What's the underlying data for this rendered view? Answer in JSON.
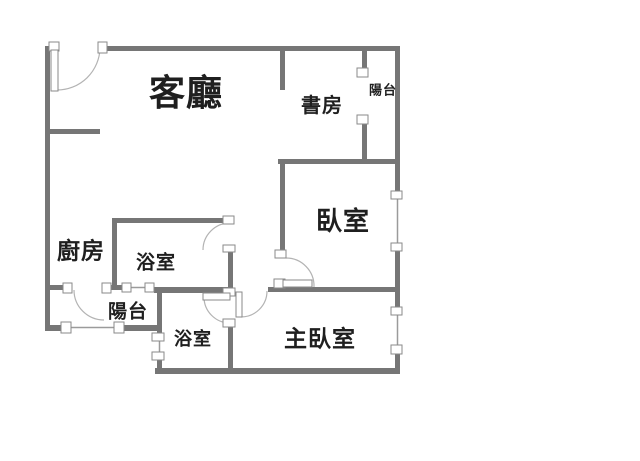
{
  "canvas": {
    "width": 640,
    "height": 461,
    "background": "#ffffff"
  },
  "colors": {
    "wall": "#767676",
    "window_line": "#9b9b9b",
    "door_arc": "#b3b3b3",
    "jamb_fill": "#ffffff",
    "jamb_border": "#8a8a8a",
    "label_text": "#1f1f1f"
  },
  "rooms": [
    {
      "id": "living-room",
      "label": "客廳",
      "cx": 186,
      "cy": 94,
      "font_size": 36
    },
    {
      "id": "study",
      "label": "書房",
      "cx": 322,
      "cy": 105,
      "font_size": 20
    },
    {
      "id": "balcony-top",
      "label": "陽台",
      "cx": 383,
      "cy": 91,
      "font_size": 13
    },
    {
      "id": "bedroom",
      "label": "臥室",
      "cx": 343,
      "cy": 222,
      "font_size": 26
    },
    {
      "id": "kitchen",
      "label": "廚房",
      "cx": 81,
      "cy": 252,
      "font_size": 23
    },
    {
      "id": "bathroom-top",
      "label": "浴室",
      "cx": 156,
      "cy": 263,
      "font_size": 19
    },
    {
      "id": "balcony-bottom",
      "label": "陽台",
      "cx": 128,
      "cy": 312,
      "font_size": 19
    },
    {
      "id": "bathroom-bottom",
      "label": "浴室",
      "cx": 193,
      "cy": 340,
      "font_size": 18
    },
    {
      "id": "master-bedroom",
      "label": "主臥室",
      "cx": 320,
      "cy": 340,
      "font_size": 23
    }
  ],
  "walls": [
    {
      "name": "top-wall",
      "rect": [
        103,
        46,
        297,
        5
      ]
    },
    {
      "name": "kitchen-stub-wall",
      "rect": [
        45,
        129,
        55,
        5
      ]
    },
    {
      "name": "study-bottom-wall",
      "rect": [
        278,
        159,
        122,
        5
      ]
    },
    {
      "name": "bath1-top-wall",
      "rect": [
        112,
        218,
        112,
        5
      ]
    },
    {
      "name": "kitchen-bottom-wall",
      "rect": [
        45,
        285,
        20,
        5
      ]
    },
    {
      "name": "mid-bottom-wall",
      "rect": [
        111,
        285,
        13,
        5
      ]
    },
    {
      "name": "bath2-top-wall",
      "rect": [
        154,
        287,
        79,
        6
      ]
    },
    {
      "name": "master-top-wall",
      "rect": [
        268,
        287,
        132,
        5
      ]
    },
    {
      "name": "balcony-bottom-left-wall",
      "rect": [
        45,
        325,
        19,
        6
      ]
    },
    {
      "name": "balcony-bottom-right-wall",
      "rect": [
        123,
        325,
        38,
        6
      ]
    },
    {
      "name": "bottom-wall",
      "rect": [
        155,
        368,
        245,
        6
      ]
    },
    {
      "name": "left-wall",
      "rect": [
        45,
        46,
        5,
        285
      ]
    },
    {
      "name": "living-study-divider",
      "rect": [
        280,
        46,
        5,
        44
      ]
    },
    {
      "name": "bedroom-left-wall",
      "rect": [
        280,
        162,
        5,
        90
      ]
    },
    {
      "name": "study-balcony-divider-upper",
      "rect": [
        362,
        46,
        5,
        25
      ]
    },
    {
      "name": "study-balcony-divider-lower",
      "rect": [
        362,
        122,
        5,
        42
      ]
    },
    {
      "name": "kitchen-bath-divider",
      "rect": [
        112,
        218,
        5,
        72
      ]
    },
    {
      "name": "hall-bath1-wall",
      "rect": [
        228,
        250,
        5,
        46
      ]
    },
    {
      "name": "bath2-left-wall-upper",
      "rect": [
        157,
        290,
        5,
        46
      ]
    },
    {
      "name": "bath2-left-wall-lower",
      "rect": [
        157,
        359,
        5,
        15
      ]
    },
    {
      "name": "bath2-master-divider",
      "rect": [
        228,
        325,
        5,
        49
      ]
    },
    {
      "name": "right-wall-top",
      "rect": [
        395,
        46,
        5,
        147
      ]
    },
    {
      "name": "right-wall-mid",
      "rect": [
        395,
        250,
        5,
        60
      ]
    },
    {
      "name": "right-wall-bottom",
      "rect": [
        395,
        352,
        5,
        22
      ]
    }
  ],
  "windows": [
    {
      "name": "balcony-bottom-window",
      "line": [
        71,
        327.5,
        116,
        327.5
      ]
    },
    {
      "name": "bath1-balcony-window",
      "line": [
        131,
        287.5,
        147,
        287.5
      ]
    },
    {
      "name": "bath2-left-window",
      "line": [
        159.5,
        341,
        159.5,
        353
      ]
    },
    {
      "name": "bedroom-right-window",
      "line": [
        397.5,
        199,
        397.5,
        244
      ]
    },
    {
      "name": "master-right-window",
      "line": [
        397.5,
        315,
        397.5,
        346
      ]
    }
  ],
  "jambs": [
    {
      "name": "entry-door-hinge-jamb",
      "rect": [
        49,
        42,
        10,
        9
      ]
    },
    {
      "name": "entry-door-jamb",
      "rect": [
        98,
        42,
        9,
        11
      ]
    },
    {
      "name": "top-balcony-jamb-upper",
      "rect": [
        357,
        68,
        11,
        9
      ]
    },
    {
      "name": "top-balcony-jamb-lower",
      "rect": [
        357,
        115,
        11,
        9
      ]
    },
    {
      "name": "right-wall-jamb-1",
      "rect": [
        391,
        191,
        11,
        8
      ]
    },
    {
      "name": "right-wall-jamb-2",
      "rect": [
        391,
        243,
        11,
        8
      ]
    },
    {
      "name": "right-wall-jamb-3",
      "rect": [
        391,
        307,
        11,
        8
      ]
    },
    {
      "name": "right-wall-jamb-4",
      "rect": [
        391,
        345,
        11,
        9
      ]
    },
    {
      "name": "bath1-door-top-jamb",
      "rect": [
        223,
        216,
        11,
        8
      ]
    },
    {
      "name": "bath1-door-bottom-jamb",
      "rect": [
        223,
        245,
        12,
        7
      ]
    },
    {
      "name": "hall-wall-bottom-jamb",
      "rect": [
        223,
        288,
        12,
        8
      ]
    },
    {
      "name": "bedroom-door-top-jamb",
      "rect": [
        275,
        250,
        11,
        8
      ]
    },
    {
      "name": "bedroom-door-leaf-jamb",
      "rect": [
        274,
        279,
        11,
        9
      ]
    },
    {
      "name": "bath2-door-bottom-jamb",
      "rect": [
        223,
        319,
        12,
        8
      ]
    },
    {
      "name": "kitchen-door-left-jamb",
      "rect": [
        63,
        283,
        9,
        10
      ]
    },
    {
      "name": "kitchen-door-right-jamb",
      "rect": [
        102,
        283,
        9,
        10
      ]
    },
    {
      "name": "balcony-window-left-cap",
      "rect": [
        61,
        322,
        10,
        11
      ]
    },
    {
      "name": "balcony-window-right-cap",
      "rect": [
        114,
        322,
        10,
        11
      ]
    },
    {
      "name": "bath1-window-left-cap",
      "rect": [
        122,
        283,
        9,
        9
      ]
    },
    {
      "name": "bath1-window-right-cap",
      "rect": [
        145,
        283,
        9,
        9
      ]
    },
    {
      "name": "bath2-window-top-cap",
      "rect": [
        152,
        333,
        12,
        8
      ]
    },
    {
      "name": "bath2-window-bottom-cap",
      "rect": [
        152,
        352,
        12,
        8
      ]
    }
  ],
  "door_leaves": [
    {
      "name": "entry-door-leaf",
      "rect": [
        51,
        50,
        7,
        41
      ]
    },
    {
      "name": "bedroom-door-leaf",
      "rect": [
        283,
        280,
        29,
        7
      ]
    },
    {
      "name": "master-door-leaf",
      "rect": [
        236,
        292,
        6,
        25
      ]
    },
    {
      "name": "bath2-door-leaf",
      "rect": [
        203,
        293,
        27,
        7
      ]
    }
  ],
  "door_arcs": [
    {
      "name": "entry-door-arc",
      "path": "M57,90 A43,43 0 0 0 100,48"
    },
    {
      "name": "bath1-door-arc",
      "path": "M203,250 A27,27 0 0 1 230,223"
    },
    {
      "name": "bedroom-door-arc",
      "path": "M286,258 A28,28 0 0 1 314,287"
    },
    {
      "name": "master-door-arc",
      "path": "M267,291 A26,26 0 0 1 241,317"
    },
    {
      "name": "bath2-door-arc",
      "path": "M204,297 A26,26 0 0 0 230,323"
    },
    {
      "name": "kitchen-door-arc",
      "path": "M74,290 A30,30 0 0 0 104,320"
    }
  ]
}
